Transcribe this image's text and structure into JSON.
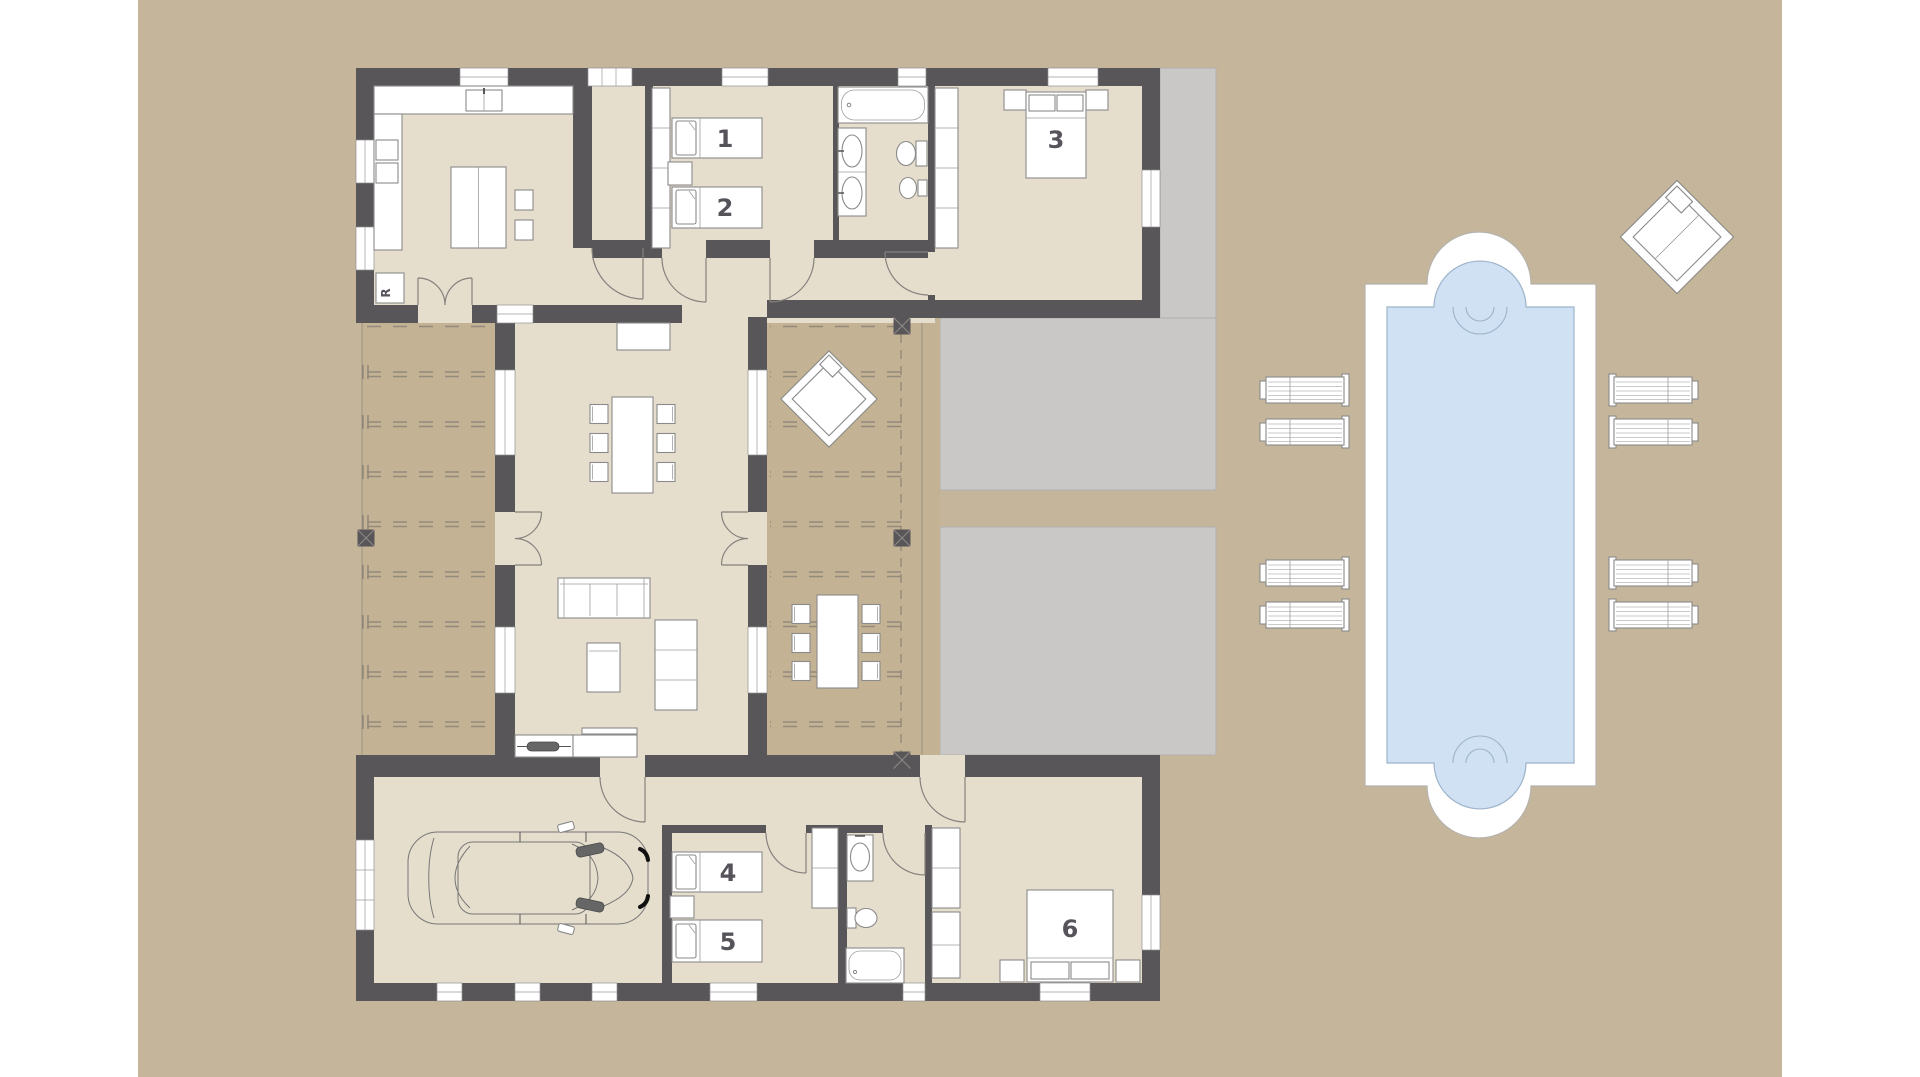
{
  "labels": {
    "room1": "1",
    "room2": "2",
    "room3": "3",
    "room4": "4",
    "room5": "5",
    "room6": "6",
    "appliance": "R"
  },
  "colors": {
    "ground": "#c5b69b",
    "floor": "#e6decd",
    "terrace": "#c3b294",
    "patio": "#c9c8c6",
    "wall": "#595659",
    "deck": "#ffffff",
    "water": "#cfe1f3",
    "water_edge": "#9db3c9",
    "outline": "#8a8a8a",
    "label": "#57535a"
  },
  "inventory": {
    "numbered_rooms": 6,
    "sun_loungers": 8,
    "outdoor_daybeds": 2,
    "cars": 1,
    "bathrooms": 2,
    "dining_chairs_indoor": 6,
    "dining_chairs_outdoor": 6
  }
}
